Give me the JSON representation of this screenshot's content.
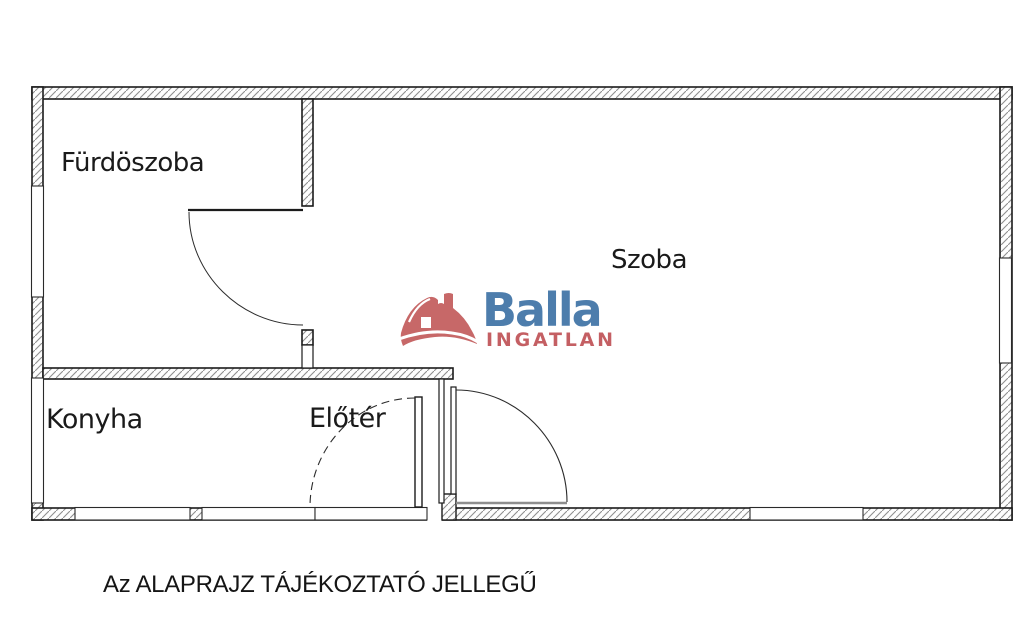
{
  "floorplan": {
    "rooms": [
      {
        "id": "furdoszoba",
        "label": "Fürdöszoba"
      },
      {
        "id": "szoba",
        "label": "Szoba"
      },
      {
        "id": "konyha",
        "label": "Konyha"
      },
      {
        "id": "eloter",
        "label": "Előtér"
      }
    ],
    "disclaimer": "Az ALAPRAJZ TÁJÉKOZTATÓ JELLEGŰ",
    "logo": {
      "brand": "Balla",
      "subbrand": "INGATLAN",
      "icon": "house-icon",
      "brand_color": "#4d7dac",
      "subbrand_color": "#c45f63",
      "house_color": "#c76868"
    },
    "colors": {
      "wall_outline": "#1b1b1b",
      "hatch_stroke": "#8f8f8f",
      "door_leaf_gray": "#8e8e8e",
      "background": "#ffffff"
    }
  }
}
